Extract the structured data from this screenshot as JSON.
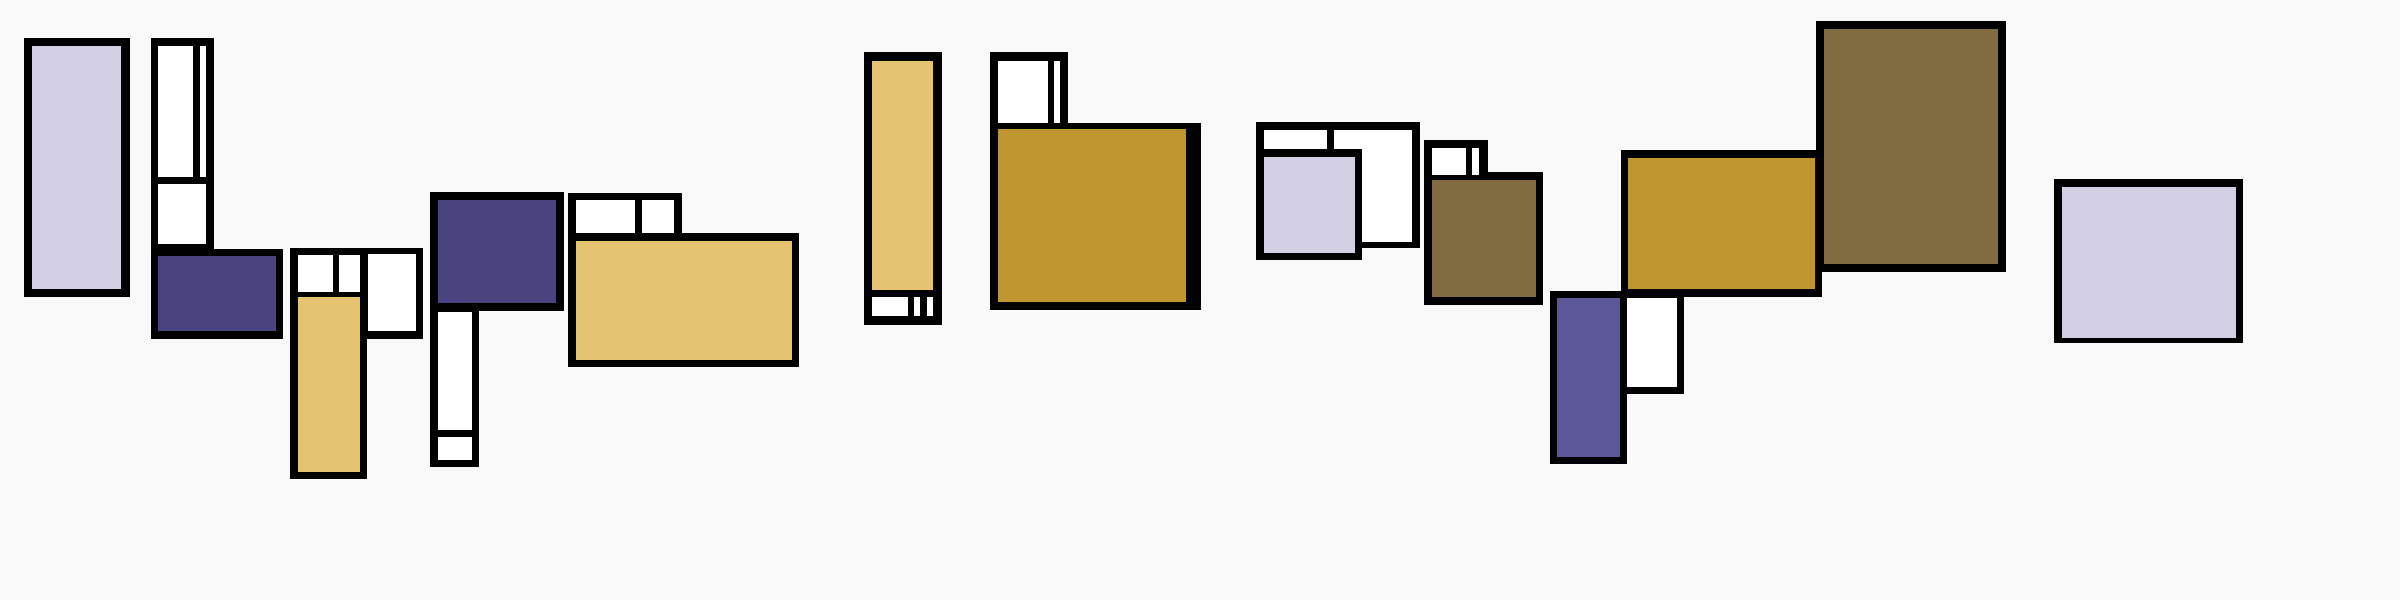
{
  "artwork": {
    "kind": "abstract-geometric-composition",
    "style": "mondrian-like block clusters",
    "visible_text": ""
  },
  "canvas": {
    "width": 2400,
    "height": 600,
    "background": "#f9f9f9"
  },
  "palette": {
    "black": "#010101",
    "white": "#ffffff",
    "lavender": "#d2cfe3",
    "indigo": "#494380",
    "violet": "#5b5798",
    "gold": "#e5c471",
    "mustard": "#bf9530",
    "olive": "#806c40"
  },
  "rects": [
    {
      "name": "cluster-a-frame",
      "color": "black",
      "x": 24,
      "y": 38,
      "w": 106,
      "h": 259
    },
    {
      "name": "cluster-a-fill",
      "color": "lavender",
      "x": 32,
      "y": 46,
      "w": 89,
      "h": 243
    },
    {
      "name": "cluster-b-column-frame",
      "color": "black",
      "x": 151,
      "y": 38,
      "w": 63,
      "h": 212
    },
    {
      "name": "cluster-b-base-frame",
      "color": "black",
      "x": 151,
      "y": 249,
      "w": 132,
      "h": 90
    },
    {
      "name": "cluster-b-cell-1",
      "color": "white",
      "x": 158,
      "y": 46,
      "w": 35,
      "h": 131
    },
    {
      "name": "cluster-b-cell-2",
      "color": "white",
      "x": 200,
      "y": 46,
      "w": 6,
      "h": 131
    },
    {
      "name": "cluster-b-cell-3",
      "color": "white",
      "x": 158,
      "y": 184,
      "w": 48,
      "h": 60
    },
    {
      "name": "cluster-b-fill",
      "color": "indigo",
      "x": 158,
      "y": 256,
      "w": 118,
      "h": 75
    },
    {
      "name": "cluster-c-top-frame",
      "color": "black",
      "x": 290,
      "y": 248,
      "w": 133,
      "h": 91
    },
    {
      "name": "cluster-c-column-frame",
      "color": "black",
      "x": 290,
      "y": 248,
      "w": 77,
      "h": 231
    },
    {
      "name": "cluster-c-cell-1",
      "color": "white",
      "x": 298,
      "y": 255,
      "w": 35,
      "h": 37
    },
    {
      "name": "cluster-c-cell-2",
      "color": "white",
      "x": 339,
      "y": 255,
      "w": 21,
      "h": 37
    },
    {
      "name": "cluster-c-cell-3",
      "color": "white",
      "x": 368,
      "y": 254,
      "w": 48,
      "h": 77
    },
    {
      "name": "cluster-c-fill",
      "color": "gold",
      "x": 298,
      "y": 297,
      "w": 62,
      "h": 175
    },
    {
      "name": "cluster-d-top-frame",
      "color": "black",
      "x": 430,
      "y": 192,
      "w": 134,
      "h": 119
    },
    {
      "name": "cluster-d-column-frame",
      "color": "black",
      "x": 430,
      "y": 192,
      "w": 49,
      "h": 275
    },
    {
      "name": "cluster-d-fill",
      "color": "indigo",
      "x": 438,
      "y": 200,
      "w": 118,
      "h": 103
    },
    {
      "name": "cluster-d-cell-1",
      "color": "white",
      "x": 438,
      "y": 312,
      "w": 34,
      "h": 118
    },
    {
      "name": "cluster-d-cell-2",
      "color": "white",
      "x": 438,
      "y": 437,
      "w": 34,
      "h": 23
    },
    {
      "name": "cluster-e-top-frame",
      "color": "black",
      "x": 568,
      "y": 193,
      "w": 114,
      "h": 48
    },
    {
      "name": "cluster-e-main-frame",
      "color": "black",
      "x": 568,
      "y": 233,
      "w": 231,
      "h": 134
    },
    {
      "name": "cluster-e-cell-1",
      "color": "white",
      "x": 576,
      "y": 200,
      "w": 59,
      "h": 33
    },
    {
      "name": "cluster-e-cell-2",
      "color": "white",
      "x": 642,
      "y": 200,
      "w": 32,
      "h": 33
    },
    {
      "name": "cluster-e-fill",
      "color": "gold",
      "x": 576,
      "y": 241,
      "w": 216,
      "h": 119
    },
    {
      "name": "cluster-f-frame",
      "color": "black",
      "x": 864,
      "y": 52,
      "w": 78,
      "h": 273
    },
    {
      "name": "cluster-f-fill",
      "color": "gold",
      "x": 872,
      "y": 61,
      "w": 61,
      "h": 229
    },
    {
      "name": "cluster-f-cell-1",
      "color": "white",
      "x": 872,
      "y": 297,
      "w": 36,
      "h": 19
    },
    {
      "name": "cluster-f-cell-2",
      "color": "white",
      "x": 914,
      "y": 297,
      "w": 6,
      "h": 19
    },
    {
      "name": "cluster-f-cell-3",
      "color": "white",
      "x": 927,
      "y": 297,
      "w": 6,
      "h": 19
    },
    {
      "name": "cluster-g-corner-frame",
      "color": "black",
      "x": 990,
      "y": 52,
      "w": 78,
      "h": 77
    },
    {
      "name": "cluster-g-main-frame",
      "color": "black",
      "x": 990,
      "y": 123,
      "w": 211,
      "h": 187
    },
    {
      "name": "cluster-g-cell-1",
      "color": "white",
      "x": 998,
      "y": 61,
      "w": 50,
      "h": 62
    },
    {
      "name": "cluster-g-cell-2",
      "color": "white",
      "x": 1054,
      "y": 61,
      "w": 6,
      "h": 62
    },
    {
      "name": "cluster-g-fill",
      "color": "mustard",
      "x": 998,
      "y": 129,
      "w": 188,
      "h": 173
    },
    {
      "name": "cluster-h-frame",
      "color": "black",
      "x": 1256,
      "y": 122,
      "w": 164,
      "h": 126
    },
    {
      "name": "cluster-h-cell-1",
      "color": "white",
      "x": 1264,
      "y": 130,
      "w": 63,
      "h": 19
    },
    {
      "name": "cluster-h-cell-2",
      "color": "white",
      "x": 1334,
      "y": 130,
      "w": 78,
      "h": 112
    },
    {
      "name": "cluster-h-inner-frame",
      "color": "black",
      "x": 1256,
      "y": 149,
      "w": 106,
      "h": 111
    },
    {
      "name": "cluster-h-fill",
      "color": "lavender",
      "x": 1264,
      "y": 157,
      "w": 91,
      "h": 96
    },
    {
      "name": "cluster-i-corner-frame",
      "color": "black",
      "x": 1424,
      "y": 140,
      "w": 64,
      "h": 40
    },
    {
      "name": "cluster-i-main-frame",
      "color": "black",
      "x": 1424,
      "y": 172,
      "w": 119,
      "h": 133
    },
    {
      "name": "cluster-i-cell-1",
      "color": "white",
      "x": 1432,
      "y": 148,
      "w": 34,
      "h": 27
    },
    {
      "name": "cluster-i-cell-2",
      "color": "white",
      "x": 1472,
      "y": 148,
      "w": 7,
      "h": 27
    },
    {
      "name": "cluster-i-fill",
      "color": "olive",
      "x": 1432,
      "y": 180,
      "w": 104,
      "h": 117
    },
    {
      "name": "cluster-k-frame",
      "color": "black",
      "x": 1621,
      "y": 150,
      "w": 201,
      "h": 147
    },
    {
      "name": "cluster-k-fill",
      "color": "mustard",
      "x": 1628,
      "y": 158,
      "w": 187,
      "h": 131
    },
    {
      "name": "cluster-j-cell-frame",
      "color": "black",
      "x": 1620,
      "y": 291,
      "w": 64,
      "h": 103
    },
    {
      "name": "cluster-j-column-frame",
      "color": "black",
      "x": 1550,
      "y": 291,
      "w": 77,
      "h": 173
    },
    {
      "name": "cluster-j-cell-1",
      "color": "white",
      "x": 1627,
      "y": 298,
      "w": 50,
      "h": 89
    },
    {
      "name": "cluster-j-fill",
      "color": "violet",
      "x": 1557,
      "y": 298,
      "w": 63,
      "h": 159
    },
    {
      "name": "cluster-l-frame",
      "color": "black",
      "x": 1816,
      "y": 21,
      "w": 190,
      "h": 251
    },
    {
      "name": "cluster-l-fill",
      "color": "olive",
      "x": 1824,
      "y": 29,
      "w": 174,
      "h": 235
    },
    {
      "name": "cluster-m-frame",
      "color": "black",
      "x": 2054,
      "y": 179,
      "w": 189,
      "h": 164
    },
    {
      "name": "cluster-m-fill",
      "color": "lavender",
      "x": 2062,
      "y": 187,
      "w": 174,
      "h": 151
    }
  ]
}
